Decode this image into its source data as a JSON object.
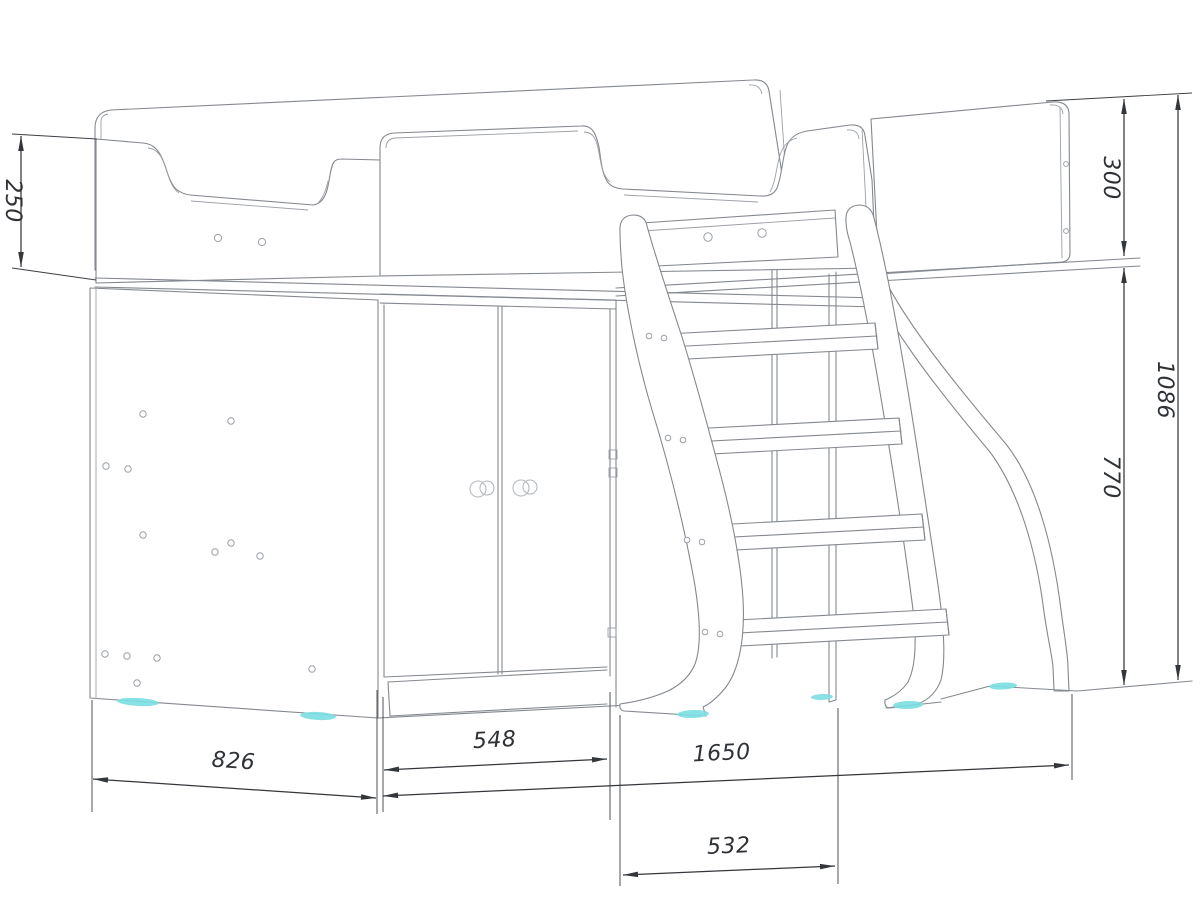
{
  "drawing": {
    "subject": "loft-bed-with-wardrobe-and-ladder-technical-drawing",
    "dimensions": {
      "d250": "250",
      "d300": "300",
      "d1086": "1086",
      "d770": "770",
      "d826": "826",
      "d548": "548",
      "d1650": "1650",
      "d532": "532"
    },
    "colors": {
      "background": "#ffffff",
      "structure_line": "#84898f",
      "dimension_line": "#33363a",
      "feet_accent": "#7bdfe2"
    }
  }
}
